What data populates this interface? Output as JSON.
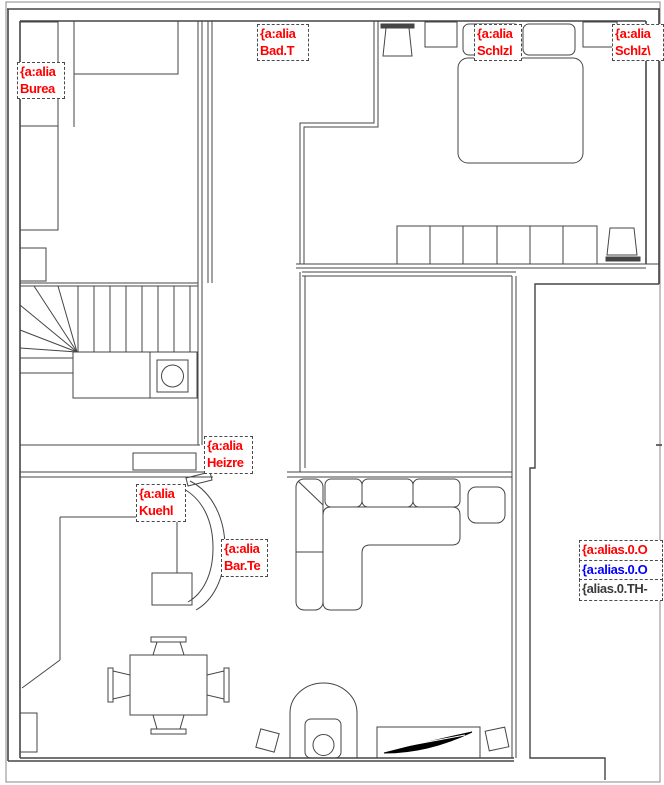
{
  "canvas": {
    "width": 664,
    "height": 785,
    "background": "#ffffff"
  },
  "colors": {
    "label_red": "#ff0000",
    "label_blue": "#0000ff",
    "label_dark": "#3a3a3a",
    "line": "#454545",
    "frame": "#8a8a8a"
  },
  "labels": {
    "bureau": {
      "line1": "{a:alia",
      "line2": "Burea"
    },
    "bad": {
      "line1": "{a:alia",
      "line2": "Bad.T"
    },
    "schlz_left": {
      "line1": "{a:alia",
      "line2": "Schlzl"
    },
    "schlz_right": {
      "line1": "{a:alia",
      "line2": "Schlz\\"
    },
    "heizung": {
      "line1": "{a:alia",
      "line2": "Heizre"
    },
    "kuehlschrank": {
      "line1": "{a:alia",
      "line2": "Kuehl"
    },
    "bar": {
      "line1": "{a:alia",
      "line2": "Bar.Te"
    },
    "terrace_red": {
      "text": "{a:alias.0.O"
    },
    "terrace_blue": {
      "text": "{a:alias.0.O"
    },
    "terrace_dark": {
      "text": "{alias.0.TH-"
    }
  }
}
